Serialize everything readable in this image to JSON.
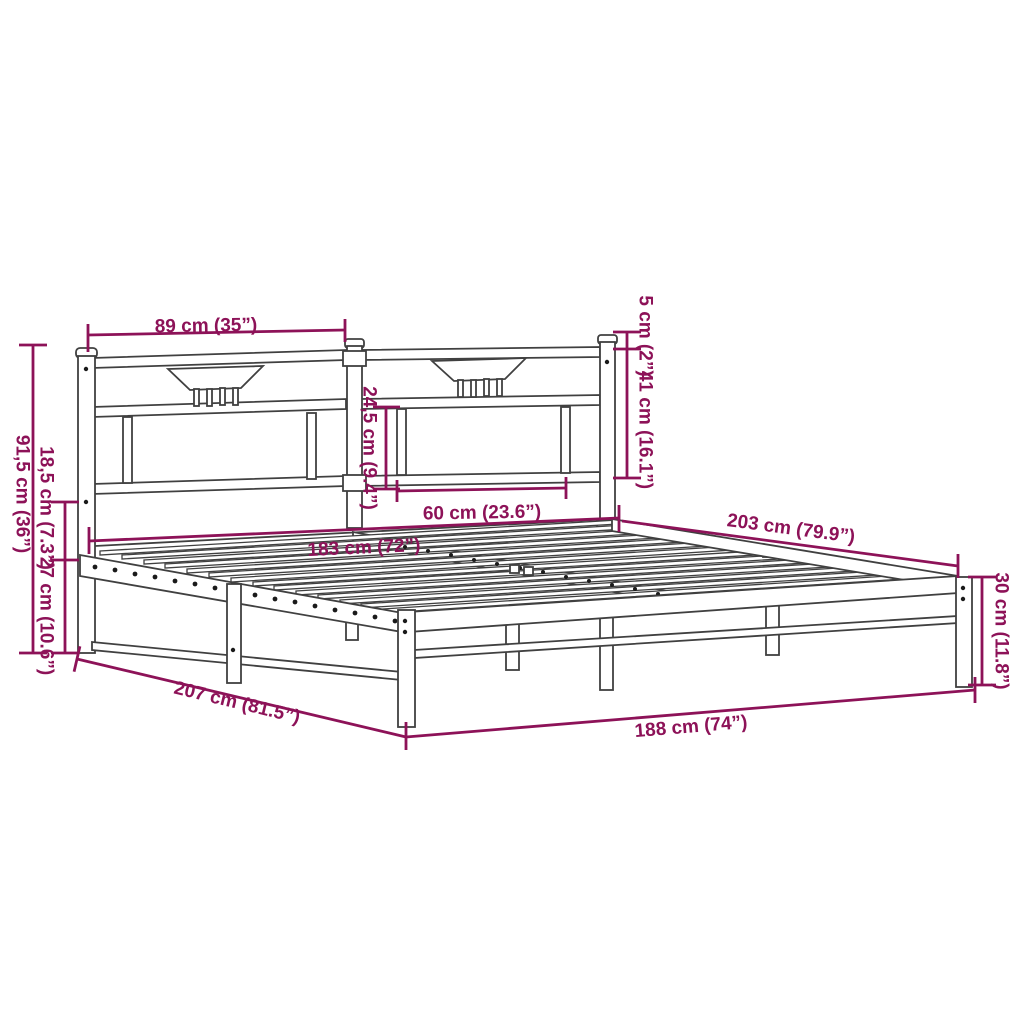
{
  "diagram": {
    "type": "product-dimension-diagram",
    "subject": "metal bed frame with headboard",
    "colors": {
      "dimension_accent": "#8D1258",
      "drawing_line": "#404040",
      "background": "#ffffff"
    },
    "dimensions": {
      "headboard_panel_width": "89 cm (35”)",
      "post_top_offset": "5 cm (2”)",
      "headboard_upper_height": "41 cm (16.1”)",
      "panel_inner_height": "24,5 cm (9.4”)",
      "panel_inner_width": "60 cm (23.6”)",
      "inner_width": "183 cm (72”)",
      "inner_length": "203 cm (79.9”)",
      "headboard_total_height": "91,5 cm (36”)",
      "frame_drop_height": "18,5 cm (7.3”)",
      "under_bed_clearance": "27 cm (10.6”)",
      "platform_height": "30 cm (11.8”)",
      "total_length": "207 cm (81.5”)",
      "total_width": "188 cm (74”)"
    }
  }
}
